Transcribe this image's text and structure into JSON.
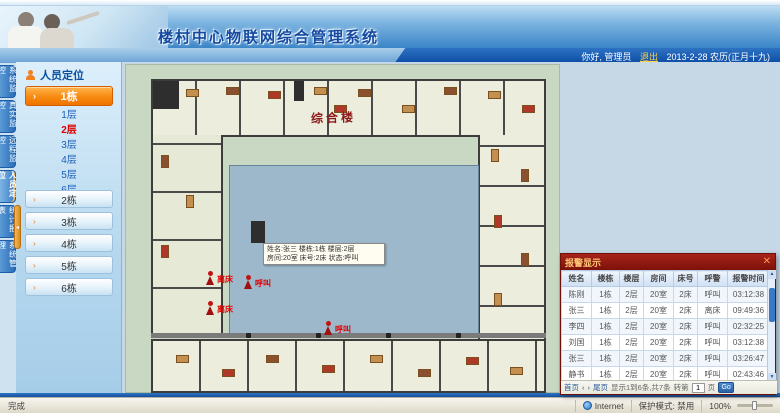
{
  "header": {
    "title": "楼村中心物联网综合管理系统",
    "greeting": "你好, 管理员",
    "logout_label": "退出",
    "date_text": "2013-2-28 农历(正月十九)"
  },
  "tabs": [
    {
      "label": "系统监控"
    },
    {
      "label": "真实监控"
    },
    {
      "label": "远程监控"
    },
    {
      "label": "人员定位"
    },
    {
      "label": "统计报表"
    },
    {
      "label": "系统管理"
    }
  ],
  "sidebar": {
    "panel_title": "人员定位",
    "active_building": "1栋",
    "floors": [
      {
        "label": "1层"
      },
      {
        "label": "2层"
      },
      {
        "label": "3层"
      },
      {
        "label": "4层"
      },
      {
        "label": "5层"
      },
      {
        "label": "6层"
      }
    ],
    "buildings": [
      "2栋",
      "3栋",
      "4栋",
      "5栋",
      "6栋"
    ]
  },
  "floorplan": {
    "building_label": "综合楼",
    "alarms": [
      {
        "label": "离床"
      },
      {
        "label": "呼叫"
      },
      {
        "label": "离床"
      },
      {
        "label": "呼叫"
      }
    ],
    "tooltip_line1": "姓名:张三 楼栋:1栋 楼层:2层",
    "tooltip_line2": "房间:20室 床号:2床 状态:呼叫"
  },
  "alarm_panel": {
    "title": "报警显示",
    "close_label": "✕",
    "columns": [
      "姓名",
      "楼栋",
      "楼层",
      "房间",
      "床号",
      "呼警",
      "报警时间"
    ],
    "rows": [
      [
        "陈刚",
        "1栋",
        "2层",
        "20室",
        "2床",
        "呼叫",
        "03:12:38"
      ],
      [
        "张三",
        "1栋",
        "2层",
        "20室",
        "2床",
        "离床",
        "09:49:36"
      ],
      [
        "李四",
        "1栋",
        "2层",
        "20室",
        "2床",
        "呼叫",
        "02:32:25"
      ],
      [
        "刘国",
        "1栋",
        "2层",
        "20室",
        "2床",
        "呼叫",
        "03:12:38"
      ],
      [
        "张三",
        "1栋",
        "2层",
        "20室",
        "2床",
        "呼叫",
        "03:26:47"
      ],
      [
        "静书",
        "1栋",
        "2层",
        "20室",
        "2床",
        "呼叫",
        "02:43:46"
      ]
    ],
    "pager": {
      "first": "首页",
      "prev": "‹",
      "next": "›",
      "last": "尾页",
      "info": "显示1到6条,共7条",
      "goto_label": "转第",
      "page_value": "1",
      "unit": "页",
      "go": "Go"
    }
  },
  "statusbar": {
    "left": "完成",
    "zone": "Internet",
    "protected_mode": "保护模式: 禁用",
    "zoom": "100%"
  }
}
